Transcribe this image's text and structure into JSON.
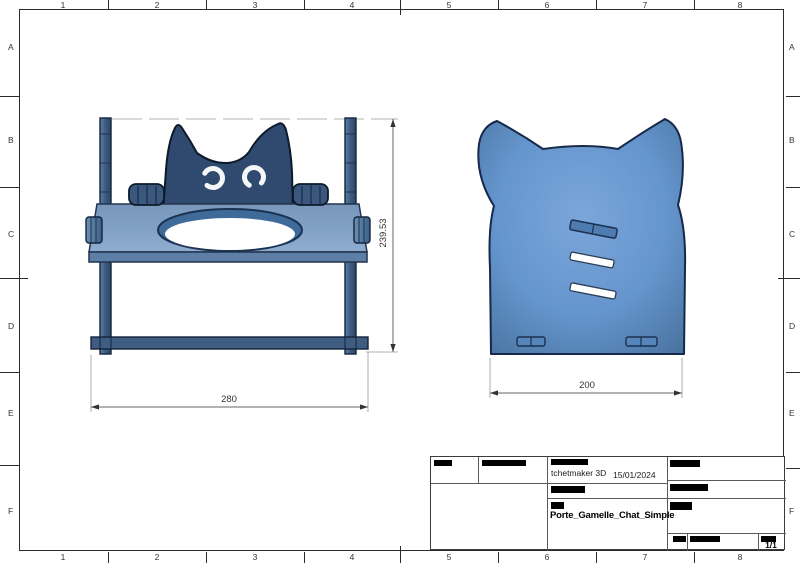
{
  "sheet": {
    "columns": [
      "1",
      "2",
      "3",
      "4",
      "5",
      "6",
      "7",
      "8"
    ],
    "rows": [
      "A",
      "B",
      "C",
      "D",
      "E",
      "F"
    ]
  },
  "views": {
    "front": {
      "label": "front-view-cat-bowl-stand",
      "dim_width": "280",
      "dim_height": "239.53"
    },
    "side": {
      "label": "side-panel-cat-silhouette",
      "dim_width": "200"
    }
  },
  "title_block": {
    "author": "tchetmaker 3D",
    "date": "15/01/2024",
    "part_name": "Porte_Gamelle_Chat_Simple",
    "sheet_number": "1/1"
  },
  "colors": {
    "panel_blue": "#4d7ab0",
    "panel_blue_light": "#7ba6da",
    "cat_navy": "#2f4a6e",
    "platform_blue": "#7d9dc2",
    "rail_blue": "#3f5d80",
    "outline": "#13243c",
    "dimension_line": "#777777",
    "redaction": "#000000"
  }
}
